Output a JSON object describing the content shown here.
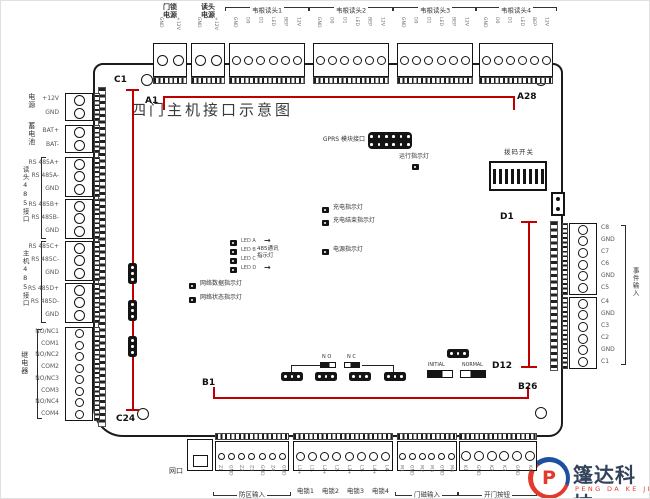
{
  "title": "四门主机接口示意图",
  "markers": {
    "a1": "A1",
    "a28": "A28",
    "b1": "B1",
    "b26": "B26",
    "c1": "C1",
    "c24": "C24",
    "d1": "D1",
    "d12": "D12"
  },
  "top": {
    "power_lock": {
      "lines": [
        "门锁",
        "电源"
      ],
      "pins": [
        "GND",
        "+12V"
      ]
    },
    "power_reader": {
      "lines": [
        "读头",
        "电源"
      ],
      "pins": [
        "GND",
        "+12V"
      ]
    },
    "wiegand": [
      {
        "label": "韦根读头1",
        "pins": [
          "GND",
          "D0",
          "D1",
          "LED",
          "BEP",
          "12V"
        ]
      },
      {
        "label": "韦根读头2",
        "pins": [
          "GND",
          "D0",
          "D1",
          "LED",
          "BEP",
          "12V"
        ]
      },
      {
        "label": "韦根读头3",
        "pins": [
          "GND",
          "D0",
          "D1",
          "LED",
          "BEP",
          "12V"
        ]
      },
      {
        "label": "韦根读头4",
        "pins": [
          "GND",
          "D0",
          "D1",
          "LED",
          "BEP",
          "12V"
        ]
      }
    ]
  },
  "left": {
    "groups": [
      {
        "label": "电源",
        "pins": [
          "+12V",
          "GND"
        ]
      },
      {
        "label": "蓄电池",
        "pins": [
          "BAT+",
          "BAT-"
        ]
      },
      {
        "label": "读头485接口",
        "blocks": [
          [
            "RS 485A+",
            "RS 485A-",
            "GND"
          ],
          [
            "RS 485B+",
            "RS 485B-",
            "GND"
          ]
        ]
      },
      {
        "label": "主机485接口",
        "blocks": [
          [
            "RS 485C+",
            "RS 485C-",
            "GND"
          ],
          [
            "RS 485D+",
            "RS 485D-",
            "GND"
          ]
        ]
      },
      {
        "label": "继电器",
        "pins": [
          "NO/NC1",
          "COM1",
          "NO/NC2",
          "COM2",
          "NO/NC3",
          "COM3",
          "NO/NC4",
          "COM4"
        ]
      }
    ]
  },
  "right": {
    "label": "事件输入",
    "blocks": [
      [
        "C8",
        "GND",
        "C7",
        "C6",
        "GND",
        "C5"
      ],
      [
        "C4",
        "GND",
        "C3",
        "C2",
        "GND",
        "C1"
      ]
    ]
  },
  "bottom": {
    "net_port": "网口",
    "blocks": [
      {
        "label": "防区输入",
        "pins": [
          "Z1",
          "GND",
          "Z2",
          "Z3",
          "GND",
          "Z4",
          "GND"
        ]
      },
      {
        "labels": [
          "电锁1",
          "电锁2",
          "电锁3",
          "电锁4"
        ],
        "pins": [
          "L1+",
          "L1-",
          "L2+",
          "L2-",
          "L3+",
          "L3-",
          "L4+",
          "L4-"
        ]
      },
      {
        "label": "门磁输入",
        "pins": [
          "M1",
          "GND",
          "M2",
          "M3",
          "GND",
          "M4"
        ]
      },
      {
        "label": "开门按钮",
        "pins": [
          "K1",
          "GND",
          "K2",
          "K3",
          "GND",
          "K4"
        ]
      }
    ]
  },
  "center": {
    "gprs_label": "GPRS 模块接口",
    "run_led": "运行指示灯",
    "charge_led": "充电指示灯",
    "charge_done_led": "充电结束指示灯",
    "power_led": "电源指示灯",
    "comm_leds": [
      "LED A",
      "LED B",
      "LED C",
      "LED D"
    ],
    "comm_label_lines": [
      "485通讯",
      "指示灯"
    ],
    "net_data_led": "网络数据指示灯",
    "net_status_led": "网络状态指示灯",
    "dip_label": "拨码开关",
    "no_label": "N O",
    "nc_label": "N C",
    "initial_label": "INITIAL",
    "normal_label": "NORMAL"
  },
  "logo": {
    "cn": "篷达科技",
    "en": "PENG DA KE JI",
    "mark": "P"
  },
  "colors": {
    "annotation": "#c00000",
    "logo_red": "#e23a2c",
    "logo_blue": "#1e4fa0"
  }
}
